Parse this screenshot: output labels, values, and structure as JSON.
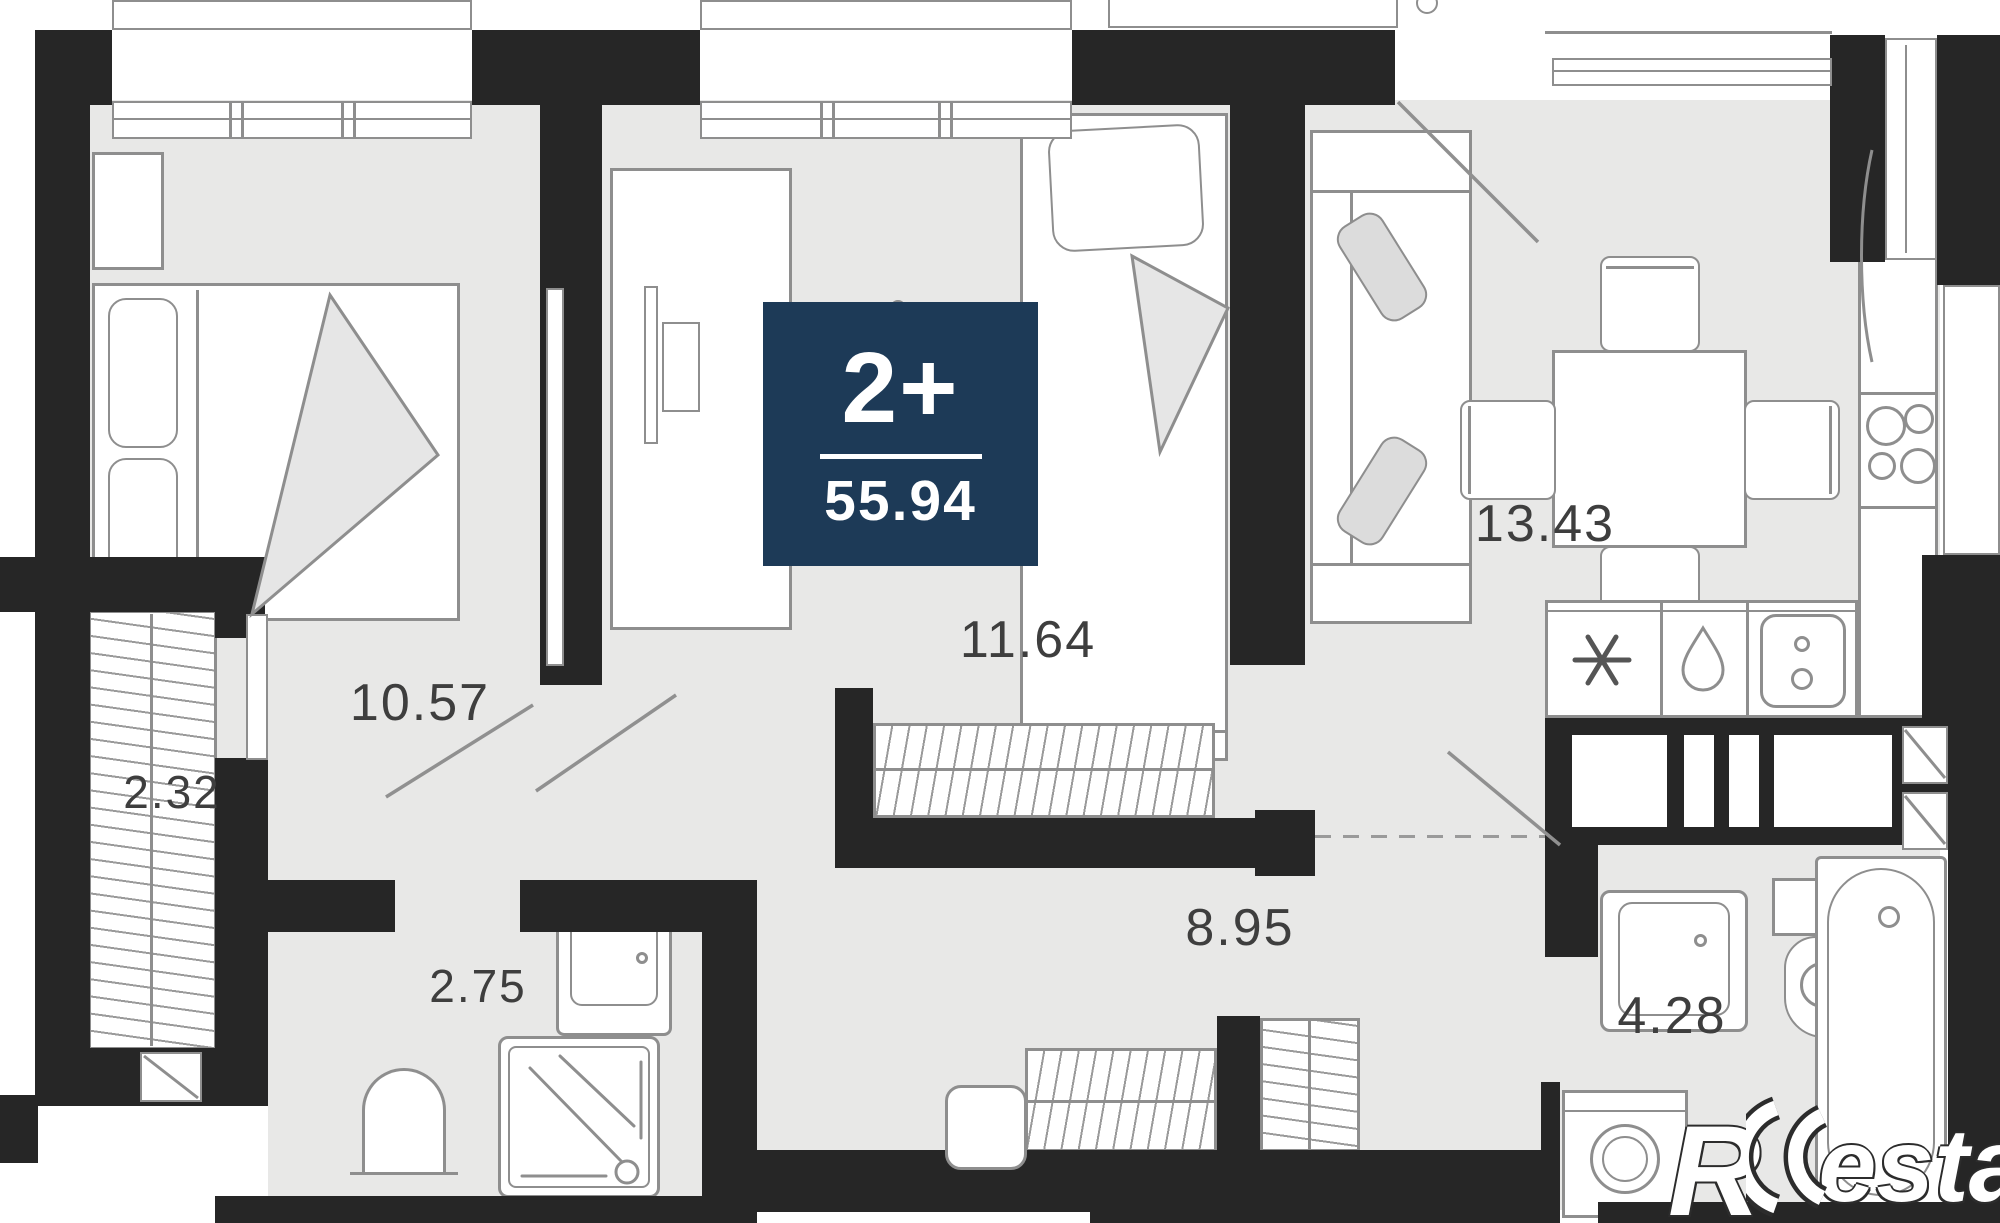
{
  "plan": {
    "badge": {
      "room_type": "2+",
      "total_area": "55.94"
    },
    "rooms": [
      {
        "id": "bedroom-main",
        "area": "10.57"
      },
      {
        "id": "closet",
        "area": "2.32"
      },
      {
        "id": "bathroom-small",
        "area": "2.75"
      },
      {
        "id": "bedroom-second",
        "area": "11.64"
      },
      {
        "id": "hallway",
        "area": "8.95"
      },
      {
        "id": "kitchen-living",
        "area": "13.43"
      },
      {
        "id": "bathroom-main",
        "area": "4.28"
      }
    ],
    "watermark": {
      "prefix": "R",
      "suffix": "estate"
    },
    "colors": {
      "wall": "#262626",
      "floor": "#e8e8e7",
      "badge_background": "#1d3a57",
      "furniture_line": "#8e8e8e",
      "label_text": "#3e3e3e"
    },
    "icons": {
      "fridge_cabinet": "snowflake-icon",
      "hob_cabinet": "drop-icon",
      "sink_cabinet": "sink-icon"
    }
  }
}
